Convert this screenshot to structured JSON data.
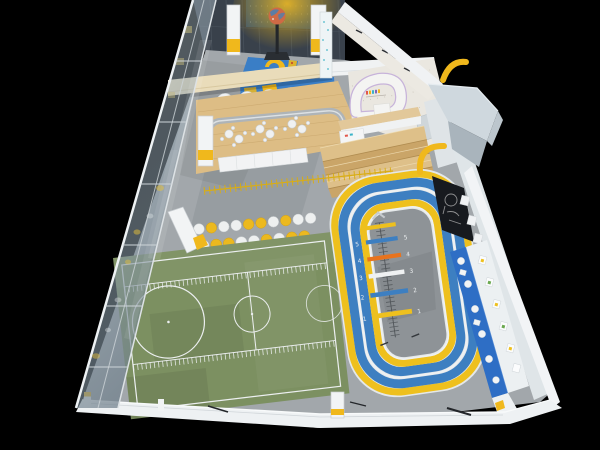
{
  "scene": {
    "description": "Aerial 3D render of a kids indoor sports training center",
    "background": "#000000"
  },
  "palette": {
    "floor_gray": "#a2a7ab",
    "infield": "#8e9397",
    "turf_green": "#7c9061",
    "track_yellow": "#eec01e",
    "track_blue": "#3d7fc1",
    "accent_yellow": "#f0b81c",
    "mat_blue": "#3a7ec6",
    "marker_orange": "#e8731d",
    "shelf_blue": "#2e6ec5",
    "wood": "#ddbd85",
    "wood_dark": "#c9a568",
    "beam_beige": "#e9dcba",
    "wall_white": "#eef1f3",
    "wall_dark": "#39414b",
    "glass_tint": "#93a4b0",
    "poster_black": "#171a1f",
    "line_white": "#eceff0",
    "trim_lavender": "#c7b3da"
  },
  "zones": {
    "basketball_area": {
      "name": "toddler basketball corner",
      "items": [
        "globe-basketball-stand",
        "blue-mat-yellow-key"
      ]
    },
    "cafe": {
      "name": "parents cafe",
      "table_clusters": 3
    },
    "reception": {
      "name": "curved reception kiosk"
    },
    "bleachers": {
      "name": "wooden bleacher steps",
      "steps": 4
    },
    "agility_floor": {
      "name": "agility dot drills + measuring ruler",
      "dot_rows": [
        [
          "white",
          "yellow",
          "white",
          "white",
          "yellow",
          "yellow",
          "white",
          "yellow",
          "white",
          "white"
        ],
        [
          "yellow",
          "white",
          "yellow",
          "yellow",
          "white",
          "white",
          "yellow",
          "white",
          "yellow",
          "yellow"
        ]
      ]
    },
    "soccer_field": {
      "name": "mini turf field with markings"
    },
    "running_track": {
      "name": "looped sprint track",
      "lane_colors_outer_to_inner": [
        "#eec01e",
        "#3d7fc1",
        "#3d7fc1",
        "#eec01e"
      ]
    },
    "jump_strip": {
      "name": "standing long-jump measuring strip",
      "markers": [
        {
          "value": "5",
          "color": "#3d7fc1"
        },
        {
          "value": "4",
          "color": "#e8731d"
        },
        {
          "value": "3",
          "color": "#eff1f2"
        },
        {
          "value": "2",
          "color": "#3d7fc1"
        },
        {
          "value": "1",
          "color": "#eec01e"
        }
      ]
    },
    "equipment_wall": {
      "name": "helmet and toy shelf wall"
    },
    "chalk_poster": {
      "name": "black sketch poster"
    },
    "entrance_pod": {
      "name": "entrance vestibule roof"
    },
    "glass_wall": {
      "name": "left glazed facade"
    }
  }
}
